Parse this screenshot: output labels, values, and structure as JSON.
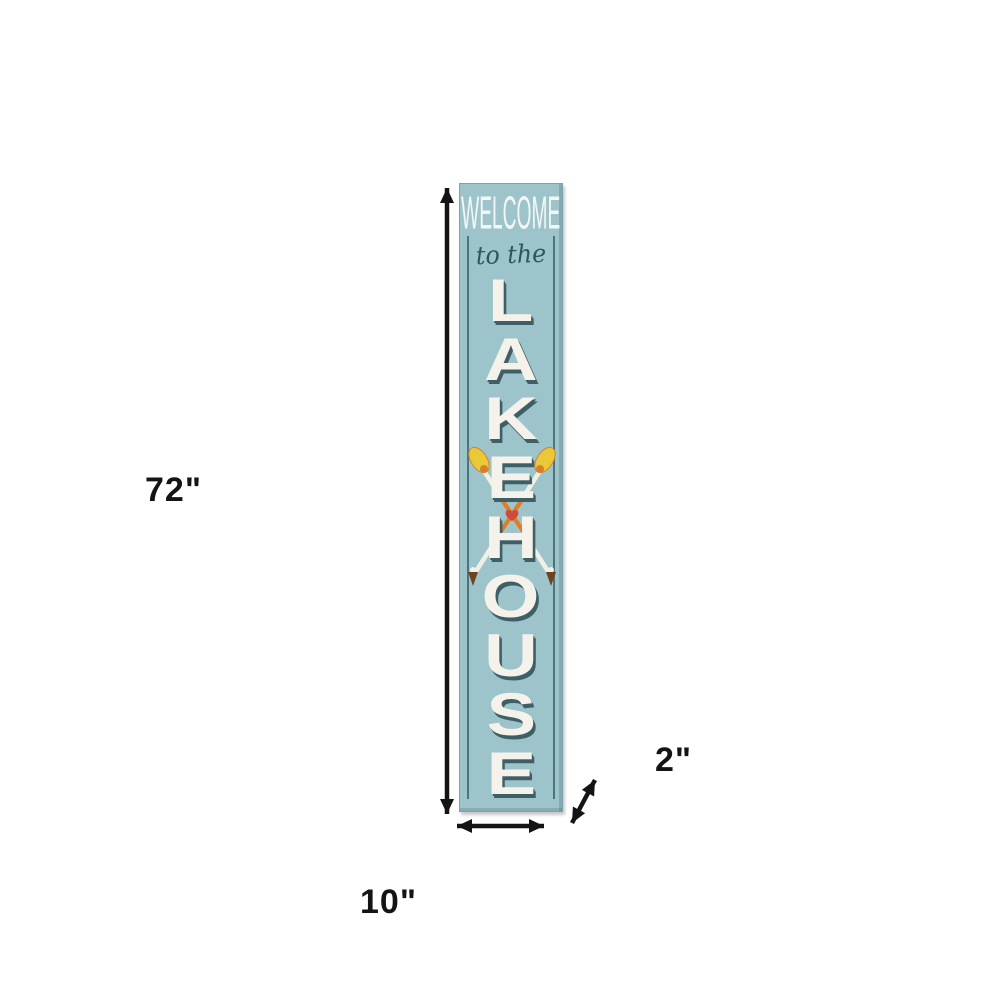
{
  "sign": {
    "welcome": "WELCOME",
    "subtitle": "to the",
    "letters": [
      "L",
      "A",
      "K",
      "E",
      "H",
      "O",
      "U",
      "S",
      "E"
    ],
    "decoration": "crossed-oars-with-heart"
  },
  "dimensions": {
    "height_label": "72\"",
    "width_label": "10\"",
    "depth_label": "2\""
  },
  "colors": {
    "sign_bg": "#9ec4cb",
    "sign_edge": "#7da4ac",
    "frame_line": "#40666d",
    "letter_fill": "#f4f2ea",
    "letter_shadow": "#3f5f67",
    "welcome_text": "#f3f6f3",
    "script_text": "#2e565e",
    "dimension_ink": "#141414",
    "oar_yellow": "#e9c938",
    "oar_orange": "#d9802e",
    "oar_brown": "#6f4322",
    "oar_white": "#f2efe6",
    "heart_red": "#d04a3a",
    "canvas_bg": "#ffffff"
  }
}
